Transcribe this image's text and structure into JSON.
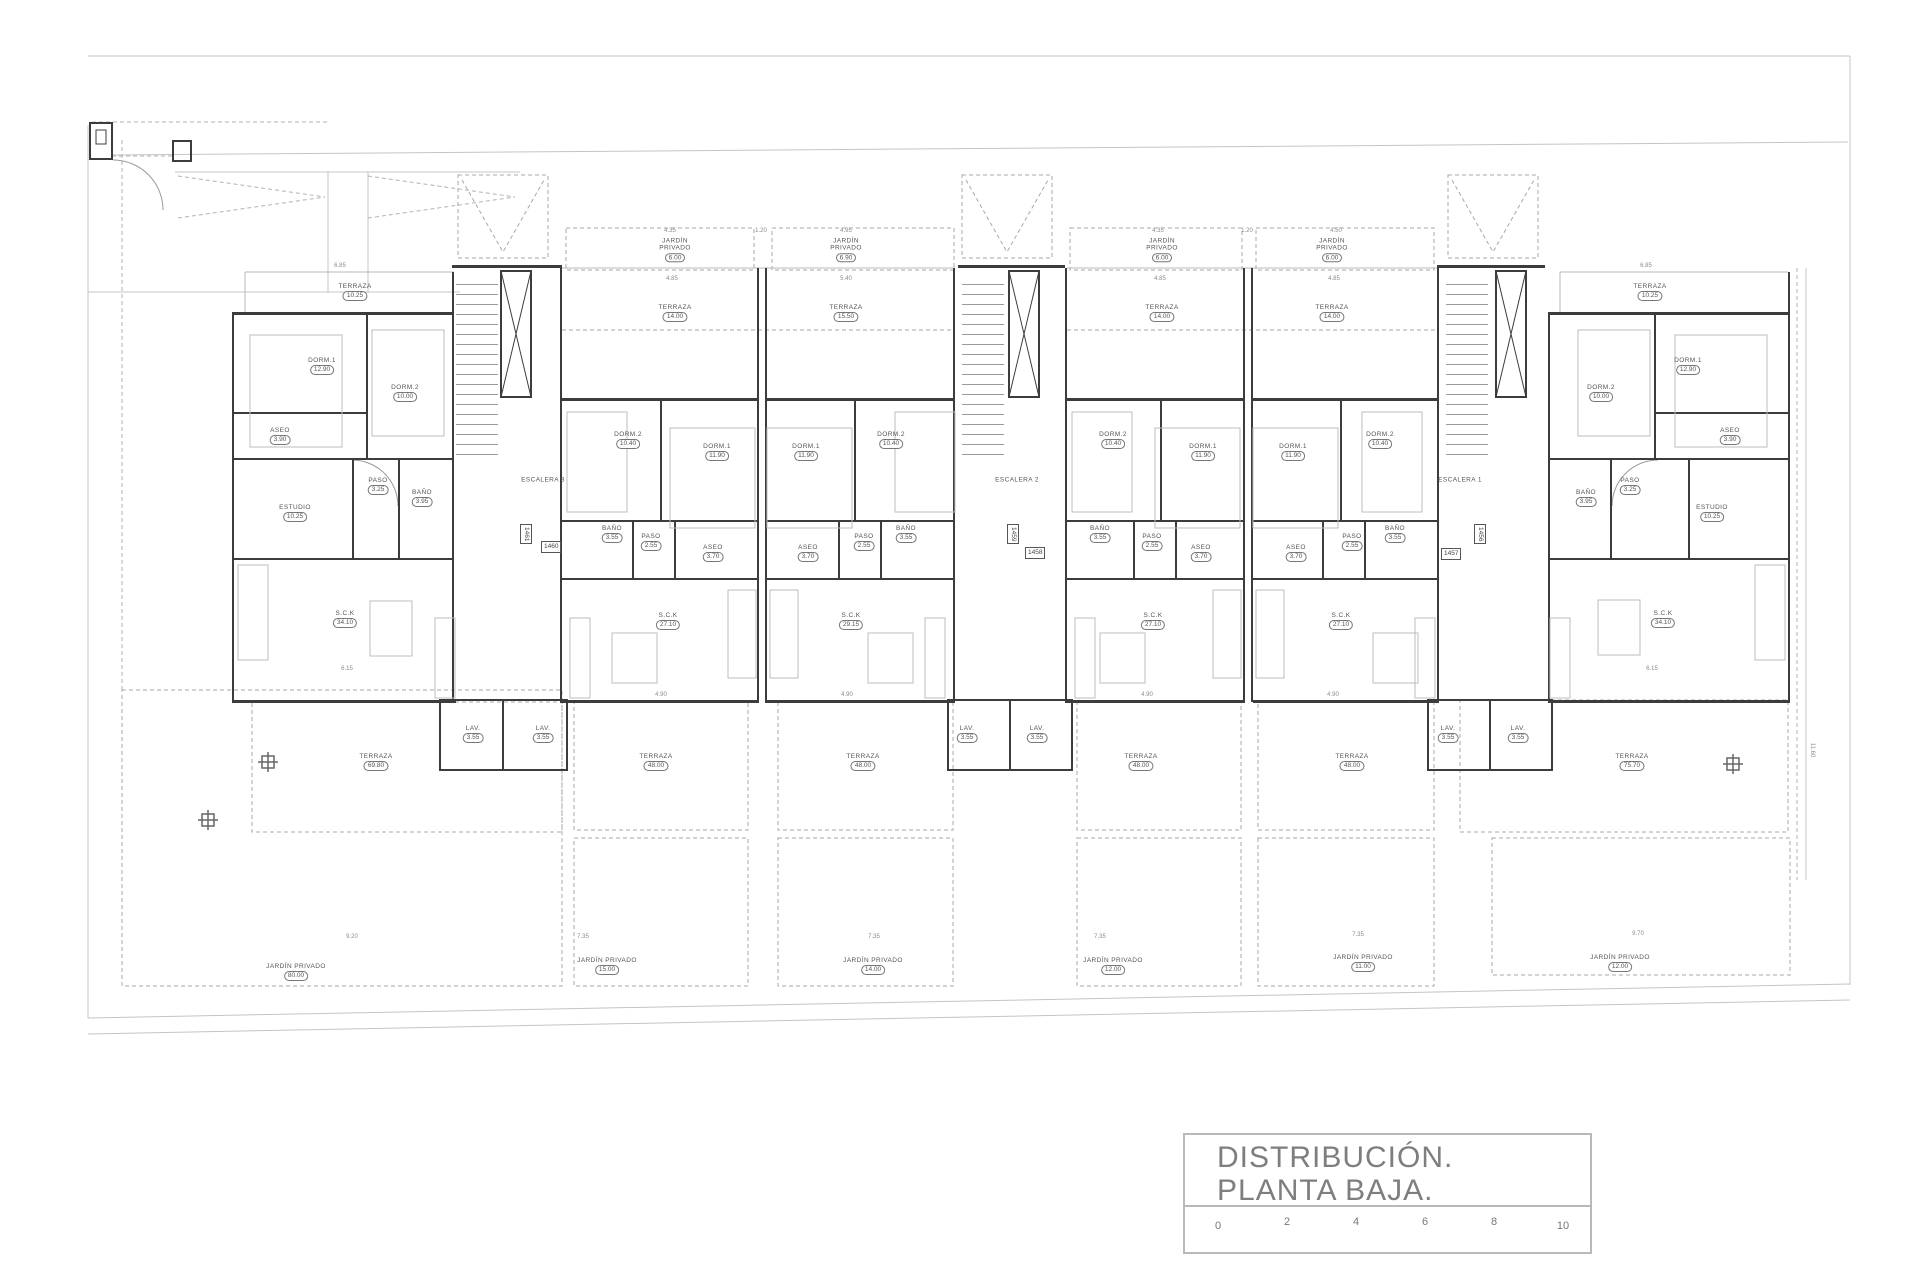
{
  "title_block": {
    "title_line1": "DISTRIBUCIÓN.",
    "title_line2": "PLANTA BAJA.",
    "scale_ticks": [
      "0",
      "2",
      "4",
      "6",
      "8",
      "10"
    ]
  },
  "stairs": [
    {
      "label": "ESCALERA 3"
    },
    {
      "label": "ESCALERA 2"
    },
    {
      "label": "ESCALERA 1"
    }
  ],
  "unit_tags": [
    "1461",
    "1460",
    "1459",
    "1458",
    "1456",
    "1457"
  ],
  "rooms": [
    {
      "name": "TERRAZA",
      "area": "10.25"
    },
    {
      "name": "DORM.1",
      "area": "12.90"
    },
    {
      "name": "DORM.2",
      "area": "10.00"
    },
    {
      "name": "ASEO",
      "area": "3.90"
    },
    {
      "name": "PASO",
      "area": "3.25"
    },
    {
      "name": "BAÑO",
      "area": "3.95"
    },
    {
      "name": "ESTUDIO",
      "area": "10.25"
    },
    {
      "name": "S.C.K",
      "area": "34.10"
    },
    {
      "name": "LAV.",
      "area": "3.55"
    },
    {
      "name": "TERRAZA",
      "area": "69.80"
    },
    {
      "name": "JARDÍN PRIVADO",
      "area": "80.00"
    },
    {
      "name": "JARDÍN PRIVADO",
      "area": "6.00"
    },
    {
      "name": "TERRAZA",
      "area": "14.00"
    },
    {
      "name": "DORM.2",
      "area": "10.40"
    },
    {
      "name": "DORM.1",
      "area": "11.90"
    },
    {
      "name": "BAÑO",
      "area": "3.55"
    },
    {
      "name": "PASO",
      "area": "2.55"
    },
    {
      "name": "ASEO",
      "area": "3.70"
    },
    {
      "name": "S.C.K",
      "area": "27.10"
    },
    {
      "name": "LAV.",
      "area": "3.55"
    },
    {
      "name": "TERRAZA",
      "area": "48.00"
    },
    {
      "name": "JARDÍN PRIVADO",
      "area": "15.00"
    },
    {
      "name": "JARDÍN PRIVADO",
      "area": "6.90"
    },
    {
      "name": "TERRAZA",
      "area": "15.50"
    },
    {
      "name": "DORM.1",
      "area": "11.90"
    },
    {
      "name": "DORM.2",
      "area": "10.40"
    },
    {
      "name": "ASEO",
      "area": "3.70"
    },
    {
      "name": "PASO",
      "area": "2.55"
    },
    {
      "name": "BAÑO",
      "area": "3.55"
    },
    {
      "name": "S.C.K",
      "area": "29.15"
    },
    {
      "name": "LAV.",
      "area": "3.55"
    },
    {
      "name": "TERRAZA",
      "area": "48.00"
    },
    {
      "name": "JARDÍN PRIVADO",
      "area": "14.00"
    },
    {
      "name": "JARDÍN PRIVADO",
      "area": "6.00"
    },
    {
      "name": "TERRAZA",
      "area": "14.00"
    },
    {
      "name": "DORM.2",
      "area": "10.40"
    },
    {
      "name": "DORM.1",
      "area": "11.90"
    },
    {
      "name": "BAÑO",
      "area": "3.55"
    },
    {
      "name": "PASO",
      "area": "2.55"
    },
    {
      "name": "ASEO",
      "area": "3.70"
    },
    {
      "name": "S.C.K",
      "area": "27.10"
    },
    {
      "name": "LAV.",
      "area": "3.55"
    },
    {
      "name": "TERRAZA",
      "area": "48.00"
    },
    {
      "name": "JARDÍN PRIVADO",
      "area": "12.00"
    },
    {
      "name": "JARDÍN PRIVADO",
      "area": "6.00"
    },
    {
      "name": "TERRAZA",
      "area": "14.00"
    },
    {
      "name": "DORM.1",
      "area": "11.90"
    },
    {
      "name": "DORM.2",
      "area": "10.40"
    },
    {
      "name": "ASEO",
      "area": "3.70"
    },
    {
      "name": "PASO",
      "area": "2.55"
    },
    {
      "name": "BAÑO",
      "area": "3.55"
    },
    {
      "name": "S.C.K",
      "area": "27.10"
    },
    {
      "name": "LAV.",
      "area": "3.55"
    },
    {
      "name": "TERRAZA",
      "area": "48.00"
    },
    {
      "name": "JARDÍN PRIVADO",
      "area": "11.00"
    },
    {
      "name": "TERRAZA",
      "area": "10.25"
    },
    {
      "name": "DORM.1",
      "area": "12.90"
    },
    {
      "name": "DORM.2",
      "area": "10.00"
    },
    {
      "name": "ASEO",
      "area": "3.90"
    },
    {
      "name": "BAÑO",
      "area": "3.95"
    },
    {
      "name": "PASO",
      "area": "3.25"
    },
    {
      "name": "ESTUDIO",
      "area": "10.25"
    },
    {
      "name": "S.C.K",
      "area": "34.10"
    },
    {
      "name": "LAV.",
      "area": "3.55"
    },
    {
      "name": "TERRAZA",
      "area": "75.70"
    },
    {
      "name": "JARDÍN PRIVADO",
      "area": "12.00"
    }
  ],
  "dims": [
    "6.85",
    "6.85",
    "4.35",
    "1.20",
    "4.95",
    "4.85",
    "5.40",
    "4.35",
    "1.20",
    "4.50",
    "4.85",
    "4.85",
    "9.20",
    "7.35",
    "7.35",
    "7.35",
    "7.35",
    "9.70",
    "4.90",
    "4.90",
    "4.90",
    "4.90",
    "6.15",
    "6.15",
    "11.60"
  ],
  "colors": {
    "wall": "#3c3c3c",
    "light_line": "#b8b8b8",
    "dashed_line": "#a8a8a8",
    "label_text": "#555555",
    "title_text": "#7e7e7e"
  }
}
